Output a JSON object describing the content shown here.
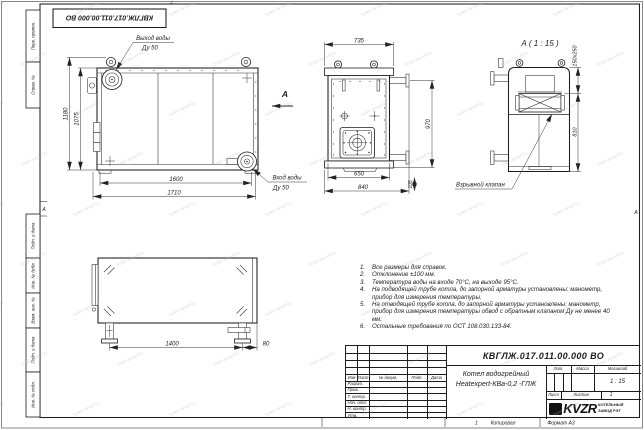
{
  "frame": {
    "stamp": "КВГЛЖ.017.011.00.000 ВО",
    "zones": {
      "top": "2",
      "left": "А",
      "right": "А",
      "bottom": "1"
    },
    "side_labels": {
      "perv": "Перв. примен.",
      "sprav": "Справ. №",
      "podp1": "Подп. и дата",
      "inv_dubl": "Инв. № дубл.",
      "vzam": "Взам. инв. №",
      "podp2": "Подп. и дата",
      "inv_podl": "Инв. № подл."
    },
    "footer": {
      "copy": "Копировал",
      "format": "Формат А3"
    }
  },
  "views": {
    "front": {
      "outlet": {
        "line1": "Выход воды",
        "line2": "Ду 50"
      },
      "inlet": {
        "line1": "Вход воды",
        "line2": "Ду 50"
      },
      "arrow": "А",
      "dims": {
        "h_overall": "1180",
        "h_body": "1075",
        "w_body": "1600",
        "w_overall": "1710"
      }
    },
    "end": {
      "dims": {
        "width": "735",
        "height": "970",
        "base_inner": "650",
        "base_outer": "840",
        "flange": "105"
      }
    },
    "detail": {
      "title": "А ( 1 : 15 )",
      "valve_label": "Взрывной клапан",
      "dims": {
        "valve": "150x250",
        "height": "810"
      }
    },
    "bottom": {
      "dims": {
        "length": "1400",
        "offset": "80"
      }
    }
  },
  "notes": {
    "items": [
      {
        "num": "1.",
        "text": "Все размеры для справок."
      },
      {
        "num": "2.",
        "text": "Отклонение ±100 мм."
      },
      {
        "num": "3.",
        "text": "Температура воды на входе 70°С, на выходе 95°С."
      },
      {
        "num": "4.",
        "text": "На подводящей трубе котла, до запорной арматуры установлены: манометр, прибор для измерения температуры."
      },
      {
        "num": "5.",
        "text": "На отводящей трубе котла, до запорной арматуры установлены: манометр, прибор для измерения температуры  обвод с обратным клапаном Ду не менее 40 мм."
      },
      {
        "num": "6.",
        "text": "Остальные требования по ОСТ 108.030.133-84."
      }
    ]
  },
  "title_block": {
    "doc_number": "КВГЛЖ.017.011.00.000 ВО",
    "name_line1": "Котел водогрейный",
    "name_line2": "Heatexpert-КВа-0,2 -ГЛЖ",
    "columns": [
      "Изм",
      "Лист",
      "№ докум.",
      "Подп.",
      "Дата"
    ],
    "rows": [
      "Разраб.",
      "Пров.",
      "Т. контр.",
      "Нач. отд.",
      "Н. контр.",
      "Утв."
    ],
    "lit_label": "Лит.",
    "mass_label": "Масса",
    "scale_label": "Масштаб",
    "scale_value": "1 : 15",
    "sheet_label": "Лист",
    "sheets_label": "Листов",
    "sheets_value": "1",
    "logo_text": "KVZR",
    "company_line1": "КОТЕЛЬНЫЙ",
    "company_line2": "ЗАВОД РЭТ"
  },
  "watermark": {
    "text": "kotel-zavod.kz"
  }
}
